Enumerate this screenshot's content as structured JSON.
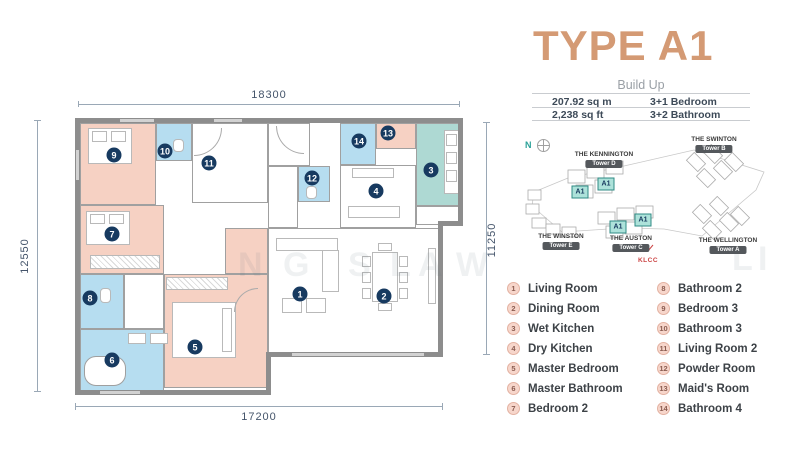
{
  "title": "TYPE A1",
  "build_up": {
    "label": "Build Up",
    "rows": [
      {
        "left": "207.92 sq m",
        "right": "3+1 Bedroom"
      },
      {
        "left": "2,238 sq ft",
        "right": "3+2 Bathroom"
      }
    ]
  },
  "dimensions": {
    "top": "18300",
    "bottom": "17200",
    "left": "12550",
    "right": "11250"
  },
  "plan": {
    "badges": [
      "1",
      "2",
      "3",
      "4",
      "5",
      "6",
      "7",
      "8",
      "9",
      "10",
      "11",
      "12",
      "13",
      "14"
    ]
  },
  "sitemap": {
    "compass": "N",
    "klcc": "KLCC",
    "towers": [
      {
        "name": "THE KENNINGTON",
        "tower": "Tower D"
      },
      {
        "name": "THE SWINTON",
        "tower": "Tower B"
      },
      {
        "name": "THE WINSTON",
        "tower": "Tower E"
      },
      {
        "name": "THE AUSTON",
        "tower": "Tower C"
      },
      {
        "name": "THE WELLINGTON",
        "tower": "Tower A"
      }
    ],
    "units": [
      "A1",
      "A1",
      "A1",
      "A1"
    ]
  },
  "legend": {
    "items": [
      {
        "num": "1",
        "label": "Living Room"
      },
      {
        "num": "2",
        "label": "Dining Room"
      },
      {
        "num": "3",
        "label": "Wet Kitchen"
      },
      {
        "num": "4",
        "label": "Dry Kitchen"
      },
      {
        "num": "5",
        "label": "Master Bedroom"
      },
      {
        "num": "6",
        "label": "Master Bathroom"
      },
      {
        "num": "7",
        "label": "Bedroom 2"
      },
      {
        "num": "8",
        "label": "Bathroom 2"
      },
      {
        "num": "9",
        "label": "Bedroom 3"
      },
      {
        "num": "10",
        "label": "Bathroom 3"
      },
      {
        "num": "11",
        "label": "Living Room 2"
      },
      {
        "num": "12",
        "label": "Powder Room"
      },
      {
        "num": "13",
        "label": "Maid's Room"
      },
      {
        "num": "14",
        "label": "Bathroom 4"
      }
    ]
  },
  "watermark": {
    "letters": [
      "N",
      "G",
      "S",
      "L",
      "A",
      "W",
      "L",
      "I"
    ]
  },
  "colors": {
    "accent_title": "#D49A74",
    "room_bedroom": "#F6D1C3",
    "room_bathroom": "#B6DDF0",
    "room_wet_kitchen": "#AED9D3",
    "wall": "#8D8D8D",
    "plan_badge": "#173A60",
    "legend_circle": "#F7D6CB",
    "tower_pill": "#54585C",
    "klcc": "#CC4444",
    "compass": "#2AA198"
  }
}
